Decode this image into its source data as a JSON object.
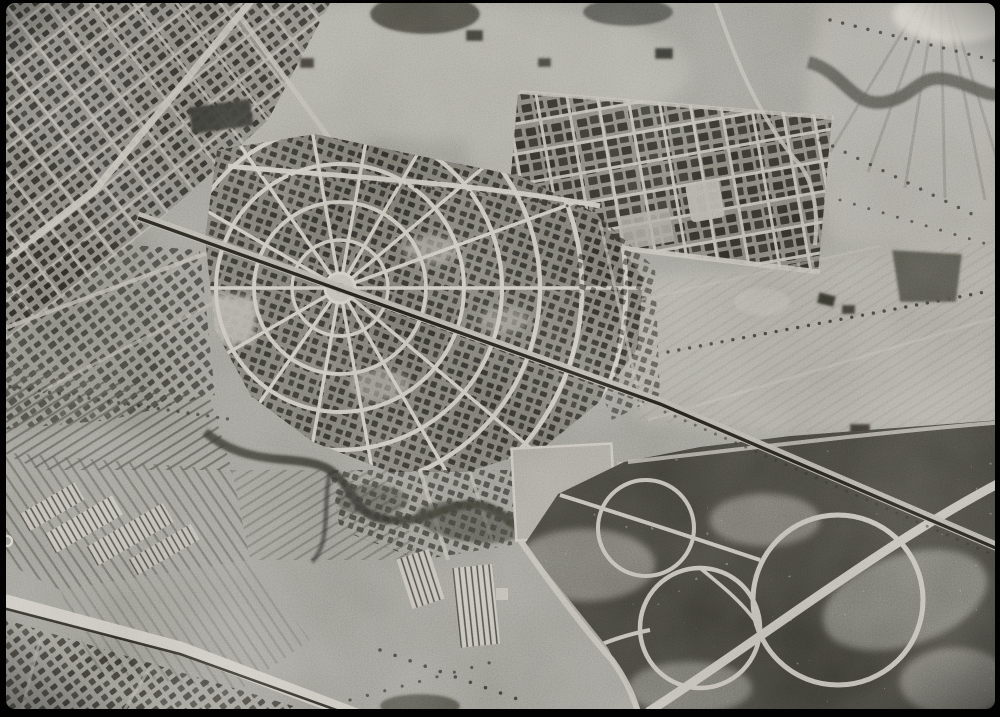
{
  "window": {
    "background": "#000000"
  },
  "photo": {
    "kind": "black-and-white aerial photograph",
    "alt": "Monochrome historical aerial photograph of a planned garden-city suburb: a fan-shaped street plan with a central circular plaza, concentric ring streets and radiating avenues; a railway line crossing diagonally through the circle; a tilted rectangular grid housing estate to the north-east; large open fields to the east; striped farm plots and striped-roof greenhouses to the south-west; and dark wooded parkland with large circular paths in the south-east. Black film border around the frame.",
    "frame_border_px": {
      "left": 6,
      "top": 3,
      "right": 5,
      "bottom": 8
    }
  },
  "palette": {
    "frame": "#020202",
    "base": "#8d8c84",
    "road": "#c1beb4",
    "roadDim": "#a9a69c",
    "housing": "#21201c",
    "urbanBase": "#716f67",
    "rail": "#191813",
    "wood": "#35342e",
    "woodPath": "#b4b1a7",
    "fieldLight": "#a09e95",
    "farm": "#85847c",
    "stripe": "#3b3a35",
    "stream": "#2b2a26",
    "bright": "#cac7bd",
    "treeDot": "#23221d"
  },
  "features": [
    {
      "name": "radial-garden-city",
      "label": "Fan-shaped planned town with central circular plaza and radiating avenues"
    },
    {
      "name": "central-circle",
      "label": "Central circular plaza"
    },
    {
      "name": "railway-line",
      "label": "Railway crossing diagonally through the town centre"
    },
    {
      "name": "grid-estate",
      "label": "Tilted rectangular grid housing estate (north-east)"
    },
    {
      "name": "open-fields",
      "label": "Large open fields with faint plot lines (east)"
    },
    {
      "name": "river",
      "label": "Winding stream band (top-right corner)"
    },
    {
      "name": "farmland",
      "label": "Striped cultivated plots (south-west)"
    },
    {
      "name": "greenhouses",
      "label": "Striped-roof greenhouses and sheds"
    },
    {
      "name": "sports-field",
      "label": "Light rectangular sports ground (centre-south)"
    },
    {
      "name": "woodland-park",
      "label": "Dark wooded parkland with circular paths (south-east)"
    },
    {
      "name": "stream-gully",
      "label": "Dark meandering gully (centre-south-west)"
    },
    {
      "name": "fiducial-mark",
      "label": "Small circular camera fiducial on left film edge"
    }
  ]
}
